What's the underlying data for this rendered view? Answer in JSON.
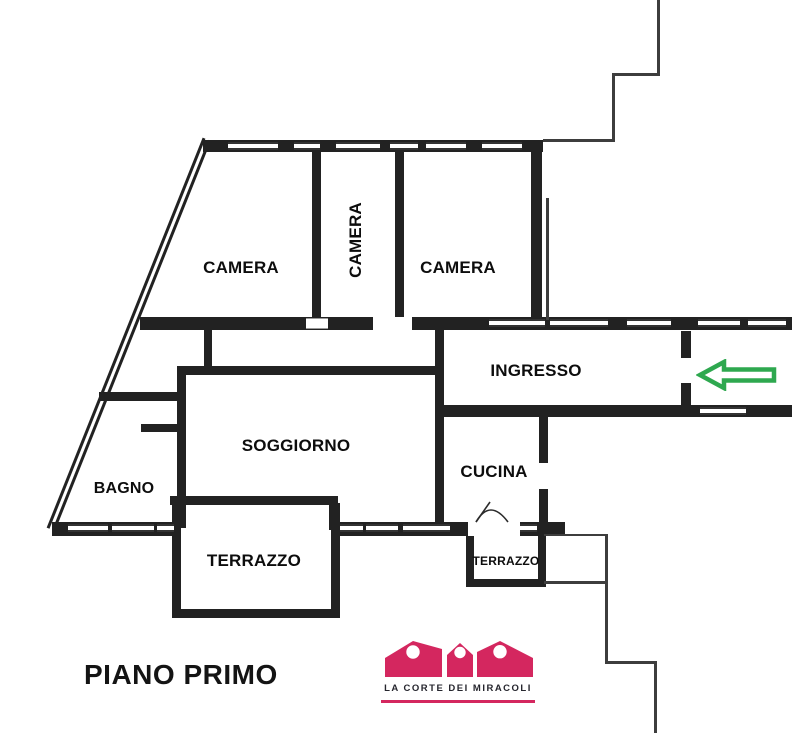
{
  "plan": {
    "title": "PIANO PRIMO",
    "rooms": [
      {
        "id": "camera-1",
        "label": "CAMERA"
      },
      {
        "id": "camera-2",
        "label": "CAMERA"
      },
      {
        "id": "camera-3",
        "label": "CAMERA"
      },
      {
        "id": "ingresso",
        "label": "INGRESSO"
      },
      {
        "id": "soggiorno",
        "label": "SOGGIORNO"
      },
      {
        "id": "bagno",
        "label": "BAGNO"
      },
      {
        "id": "cucina",
        "label": "CUCINA"
      },
      {
        "id": "terrazzo-grande",
        "label": "TERRAZZO"
      },
      {
        "id": "terrazzo-piccolo",
        "label": "TERRAZZO"
      }
    ],
    "entrance_arrow": {
      "icon": "arrow-left-icon",
      "color": "#2ea84f"
    }
  },
  "branding": {
    "logo_icon": "three-houses-icon",
    "logo_text": "LA CORTE DEI MIRACOLI",
    "brand_color": "#d4275f"
  },
  "colors": {
    "background": "#ffffff",
    "wall": "#222222",
    "label_text": "#111111",
    "arrow_green": "#2ea84f",
    "brand_pink": "#d4275f"
  }
}
